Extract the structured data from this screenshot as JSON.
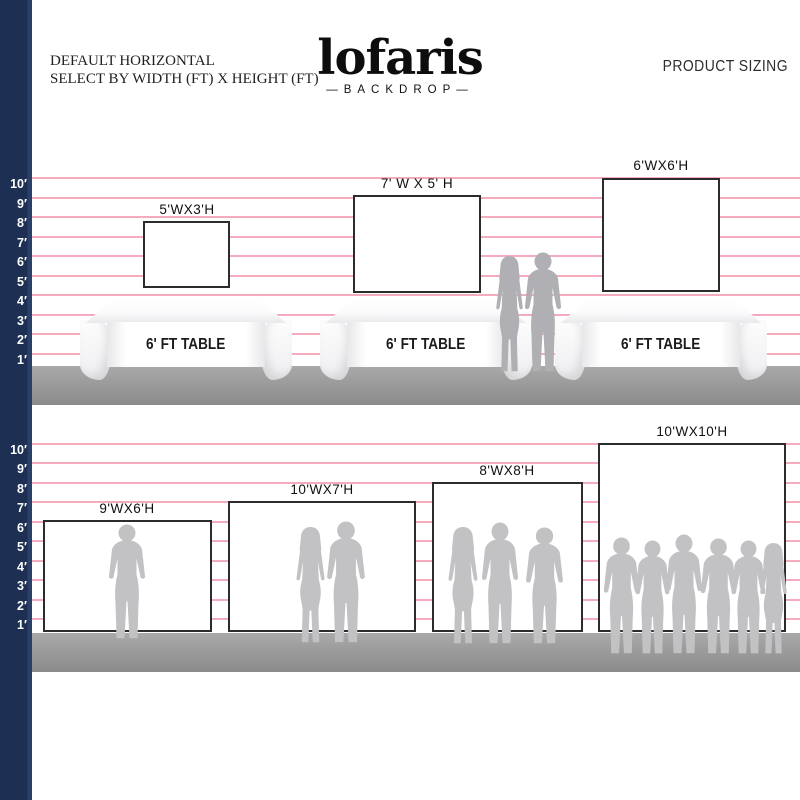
{
  "header": {
    "line1": "DEFAULT HORIZONTAL",
    "line2": "SELECT BY WIDTH (FT) X HEIGHT (FT)",
    "brand": "lofaris",
    "brand_tagline": "—BACKDROP—",
    "product_sizing": "PRODUCT SIZING"
  },
  "ruler_labels": [
    "10′",
    "9′",
    "8′",
    "7′",
    "6′",
    "5′",
    "4′",
    "3′",
    "2′",
    "1′"
  ],
  "top_section": {
    "backdrops": [
      {
        "label": "5'WX3'H"
      },
      {
        "label": "7' W X 5' H"
      },
      {
        "label": "6'WX6'H"
      }
    ],
    "table_label": "6' FT TABLE"
  },
  "bottom_section": {
    "backdrops": [
      {
        "label": "9'WX6'H"
      },
      {
        "label": "10'WX7'H"
      },
      {
        "label": "8'WX8'H"
      },
      {
        "label": "10'WX10'H"
      }
    ]
  },
  "colors": {
    "ruler_bar": "#1d2f53",
    "foot_line": "#f19cb1",
    "ground": "#979797",
    "silhouette": "#c2c2c4",
    "silhouette_dark": "#b0b0b4",
    "backdrop_border": "#2c2c2c"
  }
}
